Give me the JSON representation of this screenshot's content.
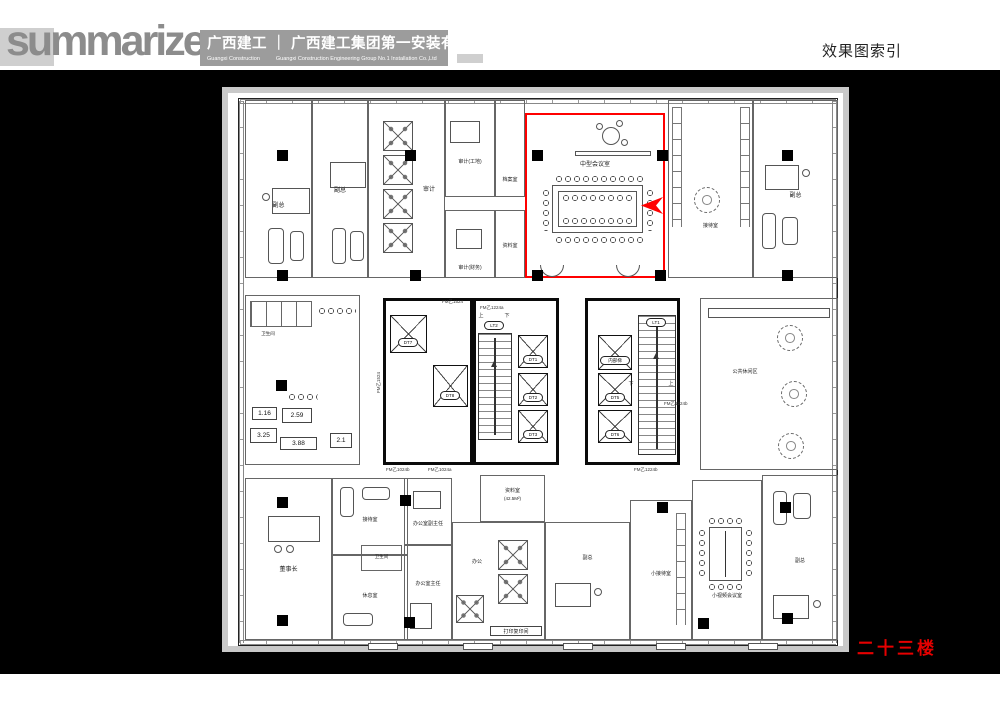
{
  "header": {
    "logo": "summarize",
    "company_cn": "广西建工 ｜ 广西建工集团第一安装有限公司",
    "company_en1": "Guangxi Construction",
    "company_en2": "Guangxi Construction Engineering Group No.1 Installation Co.,Ltd",
    "index_title": "效果图索引"
  },
  "floor_label": "二十三楼",
  "highlight": {
    "room_label": "中型会议室"
  },
  "rooms": {
    "vice": "副总",
    "audit_open": "审计",
    "audit_site": "审计(工地)",
    "audit_fin": "审计(财务)",
    "archive_small": "档案室",
    "data_room": "资料室",
    "reception": "接待室",
    "leisure": "公共休闲区",
    "chairman": "董事长",
    "rest": "休息室",
    "bath": "卫生间",
    "office_deputy_dir": "办公室副主任",
    "office_dir": "办公室主任",
    "data_room2": "资料室",
    "data_room2_area": "(42.5M²)",
    "office": "办公",
    "print": "打印复印间",
    "small_reception": "小接待室",
    "video_conf": "小视频会议室"
  },
  "core": {
    "dt1": "DT1",
    "dt2": "DT2",
    "dt3": "DT3",
    "dt5": "DT5",
    "dt6": "DT6",
    "dt7": "DT7",
    "dt8": "DT8",
    "lt1": "LT1",
    "lt2": "LT2",
    "internal": "内部梯",
    "up": "上",
    "down": "下"
  },
  "door_codes": {
    "a": "FM乙1524",
    "b": "FM乙1024a",
    "c": "FM乙1024b",
    "d": "FM乙1224a",
    "e": "FM乙1224b"
  },
  "toilet_values": [
    "1.16",
    "2.59",
    "3.25",
    "3.88",
    "2.1"
  ],
  "colors": {
    "highlight": "#ff0000",
    "floor_text": "#e60000",
    "header_block": "#9c9c9c",
    "logo_gray": "#8c8c8c",
    "canvas": "#000000"
  }
}
